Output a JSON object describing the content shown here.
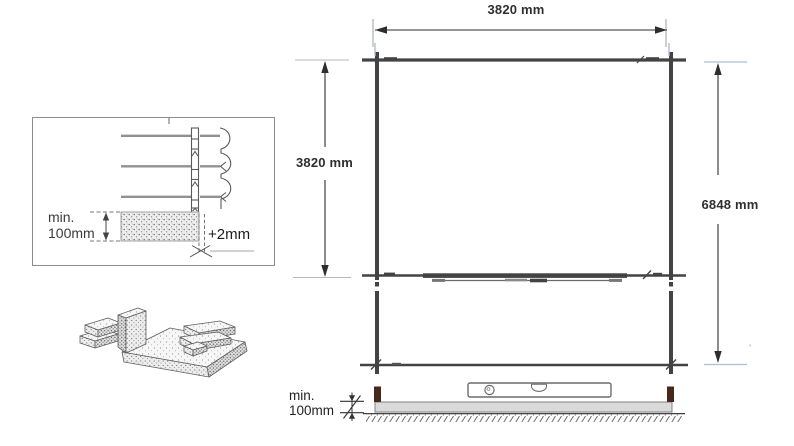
{
  "detail_panel": {
    "min_label_line1": "min.",
    "min_label_line2": "100mm",
    "gap_label": "+2mm"
  },
  "plan_view": {
    "width_label": "3820 mm",
    "depth_label": "3820 mm",
    "total_depth_label": "6848 mm"
  },
  "foundation_view": {
    "min_label_line1": "min.",
    "min_label_line2": "100mm"
  },
  "colors": {
    "frame_line": "#434343",
    "dimension_line": "#2e2e2e",
    "extension_blue": "#aabfd8",
    "extension_gray": "#b8b8b8",
    "slab_fill": "#dadada",
    "post_brown": "#46291a",
    "sketch_line": "#5f5f5f",
    "background": "#ffffff"
  }
}
